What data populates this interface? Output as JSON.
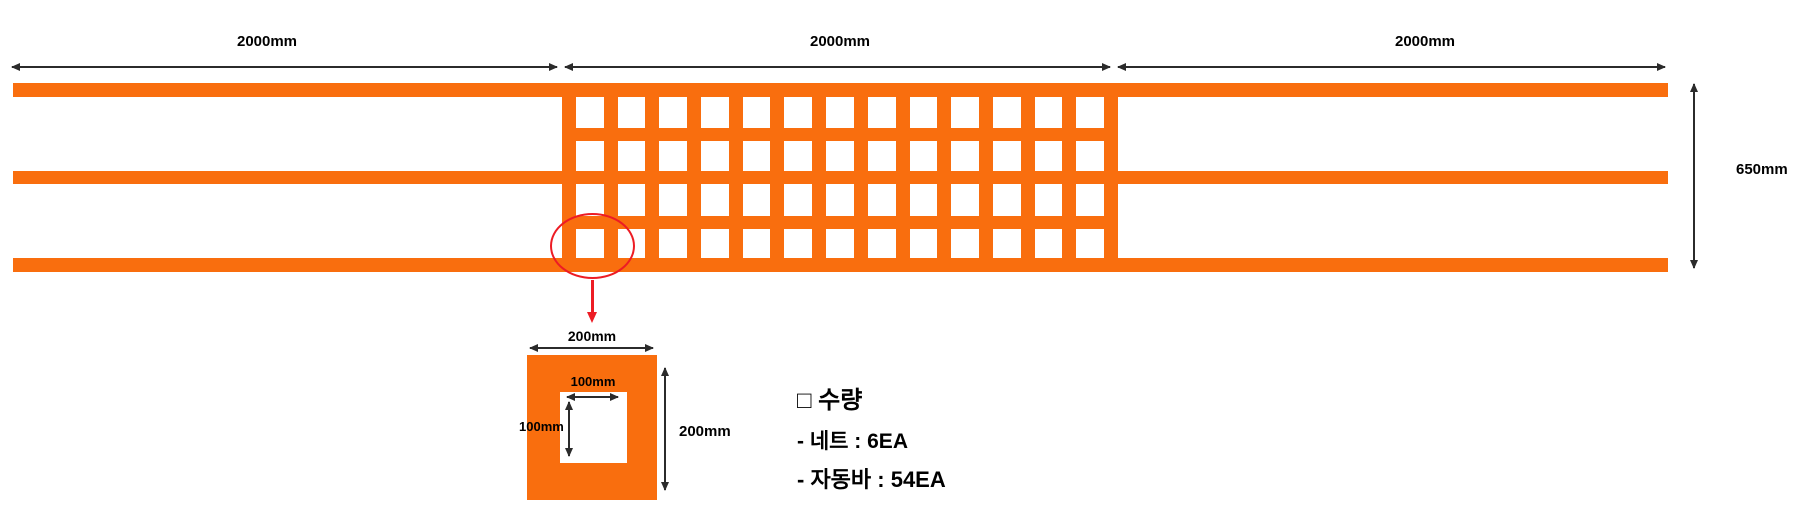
{
  "colors": {
    "orange": "#F96E0E",
    "red": "#ED1C24",
    "line": "#2b2b2b",
    "text": "#000000"
  },
  "dimensions": {
    "top_sections": [
      {
        "label": "2000mm"
      },
      {
        "label": "2000mm"
      },
      {
        "label": "2000mm"
      }
    ],
    "height_label": "650mm"
  },
  "detail": {
    "outer_width_label": "200mm",
    "outer_height_label": "200mm",
    "inner_width_label": "100mm",
    "inner_height_label": "100mm"
  },
  "notes": {
    "title": "□ 수량",
    "items": [
      {
        "label": "- 네트 : 6EA"
      },
      {
        "label": "- 자동바 : 54EA"
      }
    ]
  },
  "structure": {
    "grid_columns": 13,
    "grid_rows": 4
  }
}
